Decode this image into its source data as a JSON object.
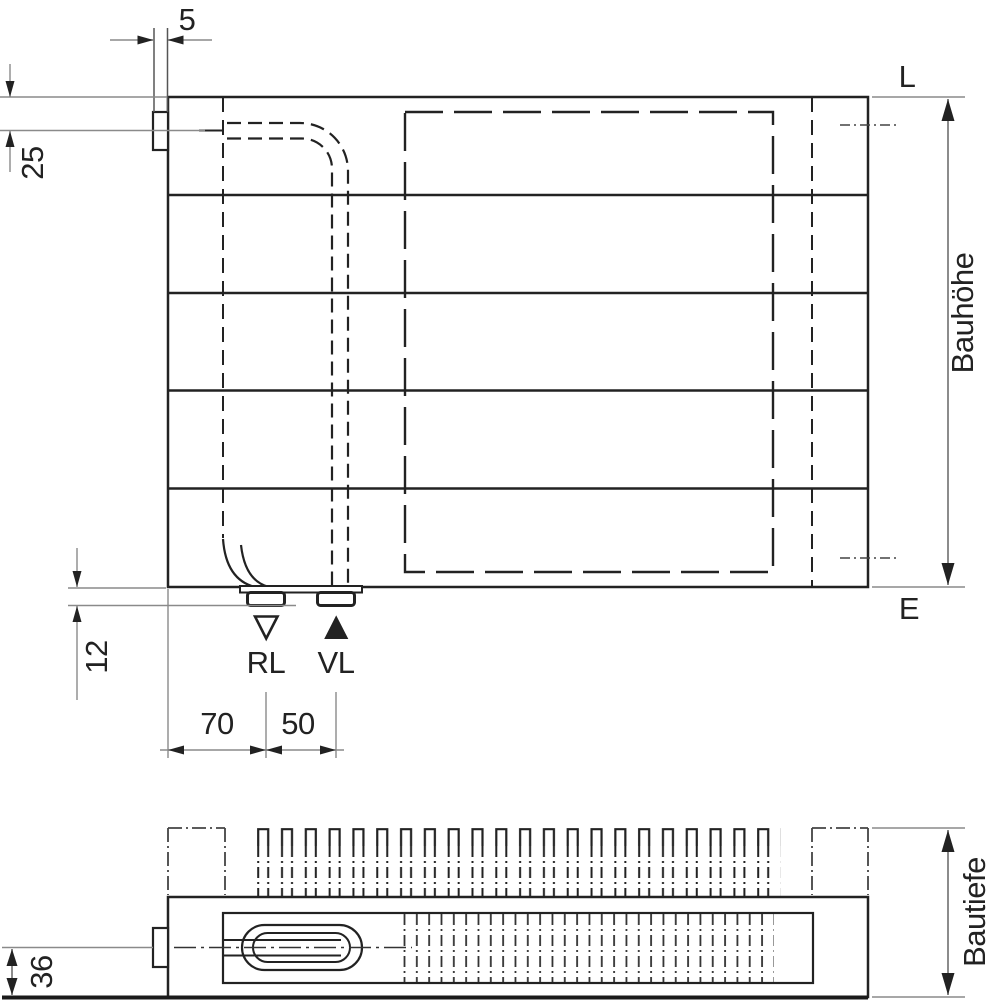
{
  "title": "Radiator installation drawing",
  "front_view": {
    "connection_labels": {
      "top": "L",
      "bottom": "E"
    },
    "flow_labels": {
      "return": "RL",
      "supply": "VL"
    },
    "dimensions": {
      "bracket_width": "5",
      "pipe_center_offset": "25",
      "stub_protrusion": "12",
      "return_offset": "70",
      "supply_spacing": "50",
      "height_label": "Bauhöhe"
    }
  },
  "top_view": {
    "dimensions": {
      "depth_label": "Bautiefe",
      "center_to_back": "36"
    }
  },
  "icons": {
    "return_marker": "triangle-down-outline",
    "supply_marker": "triangle-up-filled"
  },
  "colors": {
    "line": "#222222",
    "thin_line": "#8a8a8a",
    "background": "#ffffff"
  }
}
